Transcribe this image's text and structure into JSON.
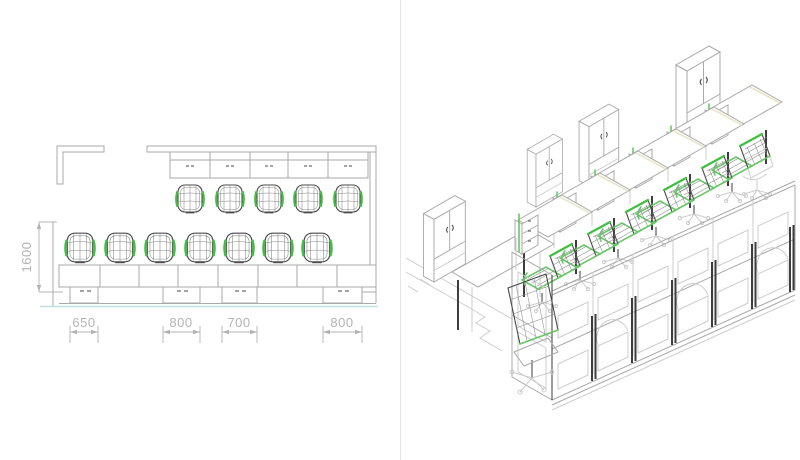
{
  "canvas": {
    "width": 800,
    "height": 460,
    "background": "#ffffff"
  },
  "plan_view": {
    "dim_vertical_label": "1600",
    "dim_bottom_labels": [
      "650",
      "800",
      "700",
      "800"
    ],
    "top_chair_count": 5,
    "bottom_chair_count": 7,
    "pedestal_count": 4
  },
  "iso_view": {
    "dim_floor_label": "1000",
    "cabinet_count": 4,
    "green_chair_count": 7,
    "workstation_count": 6
  },
  "colors": {
    "chair_green": "#3fbf3f",
    "accent_green": "#67c867",
    "line_light": "#a9a9a9",
    "line_dark": "#4a4a4a",
    "post_dark": "#3d3d3d",
    "dim_text": "#b3b3b3",
    "baseline_cyan": "#bfe0de",
    "highlight_pale_yellow": "#e9e7c9"
  }
}
